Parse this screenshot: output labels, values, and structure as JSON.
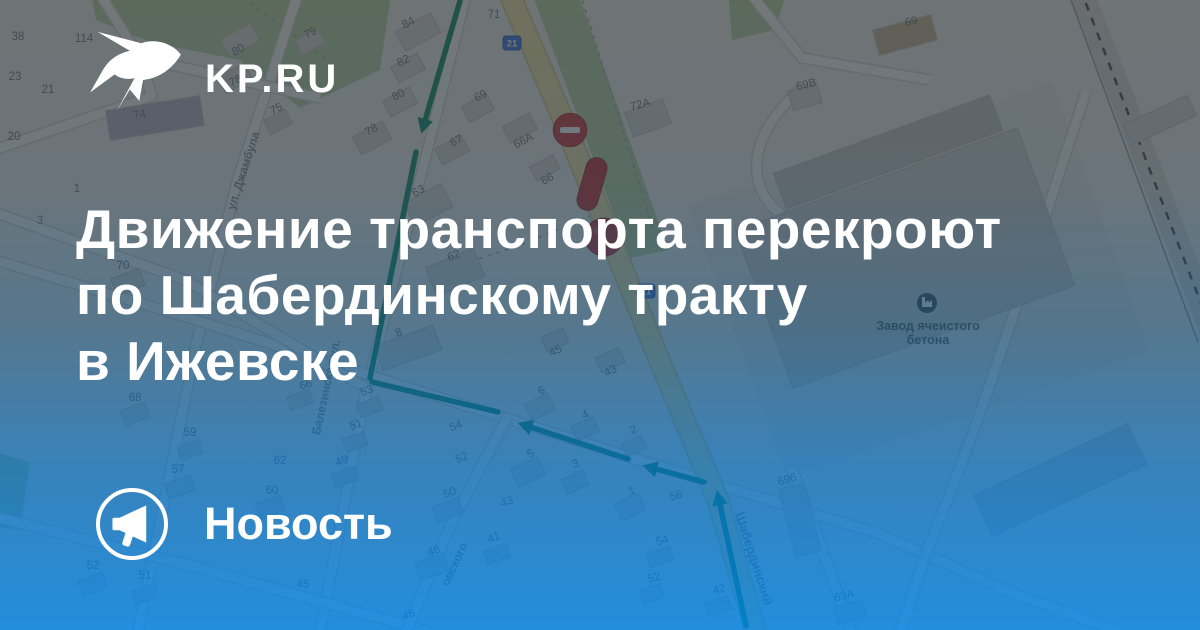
{
  "brand": {
    "logo_text": "KP.RU",
    "label": "Новость"
  },
  "headline": {
    "line1": "Движение транспорта перекроют",
    "line2": "по Шабердинскому тракту",
    "line3": "в Ижевске"
  },
  "colors": {
    "overlay_top": "#2c3439",
    "overlay_bottom": "#017edb",
    "text": "#ffffff",
    "route_green": "#0c8a63",
    "marker_red": "#d23438",
    "road_yellow": "#f2e4a2",
    "badge_blue": "#3d72d9"
  },
  "map": {
    "palette": {
      "land": "#f0efe9",
      "park": "#b9d2a0",
      "building": "#dbd8d1",
      "building_stroke": "#c3bfb6",
      "street_fill": "#fbfaf5",
      "street_casing": "#d6d3ca",
      "number_gray": "#737476",
      "label_gray": "#8b8d90",
      "poi_dark": "#3f4851"
    },
    "parks": [
      "M90,-12 L392,-12 L380,70 L300,108 L240,60 L150,42 L96,20 Z",
      "M728,-12 L788,-12 L775,30 L732,40 Z",
      "M530,-12 L576,-12 L668,250 L630,258 Z",
      "M-12,450 L30,462 L20,530 L-12,525 Z"
    ],
    "grounds": [
      "M688,206 L1052,82 L1150,352 L788,478 Z"
    ],
    "dashed_paths": [
      "M235,-8 L330,62",
      "M580,-8 L655,235",
      "M600,212 L520,245 L470,262"
    ],
    "streets": [
      "M468,-12 L428,148 L366,390 L320,632",
      "M300,-12 L238,178 L196,345 L138,632",
      "M-12,258 L180,315 L384,380 L700,479 L880,534 L1010,592 L1120,632",
      "M-12,210 L185,280 L366,388",
      "M-12,515 L200,568 L430,632",
      "M96,-12 L140,58 L152,96 L-12,152",
      "M140,58 L320,98",
      "M508,416 L452,522 L406,632",
      "M800,90 C742,140 742,200 802,228 L860,242",
      "M1086,92 C1030,260 990,400 928,548 L900,632",
      "M792,468 L852,632",
      "M746,-12 L802,58 L930,80"
    ],
    "tract": "M506,-14 L560,112 L600,212 L660,362 L718,500 L756,632",
    "railway": {
      "band": "M1080,-12 L1212,332",
      "dash": "M1080,-12 L1212,332",
      "thin": "M1068,-8 L1198,342"
    },
    "buildings": [
      {
        "x": 155,
        "y": 118,
        "w": 95,
        "h": 30,
        "r": -9,
        "f": "#b7b4c0"
      },
      {
        "x": 240,
        "y": 40,
        "w": 34,
        "h": 20,
        "r": -28
      },
      {
        "x": 235,
        "y": 78,
        "w": 30,
        "h": 18,
        "r": -28
      },
      {
        "x": 310,
        "y": 42,
        "w": 26,
        "h": 16,
        "r": -28
      },
      {
        "x": 278,
        "y": 122,
        "w": 24,
        "h": 16,
        "r": -28
      },
      {
        "x": 418,
        "y": 32,
        "w": 40,
        "h": 22,
        "r": -28
      },
      {
        "x": 408,
        "y": 68,
        "w": 30,
        "h": 18,
        "r": -28
      },
      {
        "x": 400,
        "y": 102,
        "w": 30,
        "h": 18,
        "r": -28
      },
      {
        "x": 372,
        "y": 138,
        "w": 34,
        "h": 20,
        "r": -28
      },
      {
        "x": 478,
        "y": 108,
        "w": 28,
        "h": 18,
        "r": -28
      },
      {
        "x": 452,
        "y": 150,
        "w": 30,
        "h": 18,
        "r": -28
      },
      {
        "x": 428,
        "y": 205,
        "w": 42,
        "h": 26,
        "r": -28
      },
      {
        "x": 520,
        "y": 128,
        "w": 30,
        "h": 18,
        "r": -28
      },
      {
        "x": 545,
        "y": 168,
        "w": 26,
        "h": 16,
        "r": -28
      },
      {
        "x": 648,
        "y": 118,
        "w": 40,
        "h": 26,
        "r": -20
      },
      {
        "x": 455,
        "y": 272,
        "w": 52,
        "h": 30,
        "r": -22
      },
      {
        "x": 408,
        "y": 348,
        "w": 62,
        "h": 26,
        "r": -20
      },
      {
        "x": 128,
        "y": 282,
        "w": 30,
        "h": 18,
        "r": -20
      },
      {
        "x": 555,
        "y": 340,
        "w": 24,
        "h": 16,
        "r": -25
      },
      {
        "x": 610,
        "y": 360,
        "w": 26,
        "h": 16,
        "r": -25
      },
      {
        "x": 540,
        "y": 407,
        "w": 26,
        "h": 18,
        "r": -25
      },
      {
        "x": 585,
        "y": 429,
        "w": 24,
        "h": 16,
        "r": -25
      },
      {
        "x": 634,
        "y": 446,
        "w": 22,
        "h": 14,
        "r": -25
      },
      {
        "x": 528,
        "y": 472,
        "w": 30,
        "h": 20,
        "r": -25
      },
      {
        "x": 575,
        "y": 482,
        "w": 24,
        "h": 16,
        "r": -25
      },
      {
        "x": 630,
        "y": 507,
        "w": 26,
        "h": 18,
        "r": -25
      },
      {
        "x": 93,
        "y": 584,
        "w": 26,
        "h": 16,
        "r": -20
      },
      {
        "x": 145,
        "y": 594,
        "w": 24,
        "h": 14,
        "r": -20
      },
      {
        "x": 180,
        "y": 487,
        "w": 28,
        "h": 16,
        "r": -20
      },
      {
        "x": 270,
        "y": 507,
        "w": 26,
        "h": 16,
        "r": -20
      },
      {
        "x": 345,
        "y": 477,
        "w": 24,
        "h": 14,
        "r": -20
      },
      {
        "x": 370,
        "y": 407,
        "w": 24,
        "h": 14,
        "r": -20
      },
      {
        "x": 355,
        "y": 442,
        "w": 22,
        "h": 14,
        "r": -20
      },
      {
        "x": 300,
        "y": 400,
        "w": 24,
        "h": 14,
        "r": -20
      },
      {
        "x": 135,
        "y": 414,
        "w": 26,
        "h": 16,
        "r": -20
      },
      {
        "x": 190,
        "y": 450,
        "w": 22,
        "h": 14,
        "r": -20
      },
      {
        "x": 448,
        "y": 510,
        "w": 28,
        "h": 16,
        "r": -20
      },
      {
        "x": 432,
        "y": 567,
        "w": 30,
        "h": 18,
        "r": -20
      },
      {
        "x": 497,
        "y": 554,
        "w": 24,
        "h": 14,
        "r": -20
      },
      {
        "x": 660,
        "y": 557,
        "w": 24,
        "h": 14,
        "r": -20
      },
      {
        "x": 652,
        "y": 594,
        "w": 22,
        "h": 14,
        "r": -20
      },
      {
        "x": 718,
        "y": 606,
        "w": 24,
        "h": 14,
        "r": -20
      },
      {
        "x": 800,
        "y": 520,
        "w": 26,
        "h": 70,
        "r": -15
      },
      {
        "x": 850,
        "y": 612,
        "w": 30,
        "h": 18,
        "r": -15
      },
      {
        "x": 805,
        "y": 97,
        "w": 30,
        "h": 20,
        "r": -15
      },
      {
        "x": 905,
        "y": 35,
        "w": 60,
        "h": 26,
        "r": -15,
        "f": "#c9b38f"
      },
      {
        "x": 905,
        "y": 258,
        "w": 300,
        "h": 168,
        "r": -20,
        "f": "#cfcfcb"
      },
      {
        "x": 888,
        "y": 152,
        "w": 230,
        "h": 38,
        "r": -20,
        "f": "#c6c6c2"
      },
      {
        "x": 1060,
        "y": 480,
        "w": 170,
        "h": 45,
        "r": -25,
        "f": "#cfcfcb"
      },
      {
        "x": 1160,
        "y": 120,
        "w": 70,
        "h": 22,
        "r": -25
      }
    ],
    "house_numbers": [
      {
        "t": "38",
        "x": 18,
        "y": 40
      },
      {
        "t": "114",
        "x": 84,
        "y": 42
      },
      {
        "t": "23",
        "x": 15,
        "y": 80
      },
      {
        "t": "21",
        "x": 48,
        "y": 93
      },
      {
        "t": "20",
        "x": 14,
        "y": 140
      },
      {
        "t": "1",
        "x": 77,
        "y": 192
      },
      {
        "t": "3",
        "x": 40,
        "y": 224
      },
      {
        "t": "74",
        "x": 140,
        "y": 118,
        "r": -8
      },
      {
        "t": "80",
        "x": 240,
        "y": 53,
        "r": -28
      },
      {
        "t": "78",
        "x": 237,
        "y": 84,
        "r": -28
      },
      {
        "t": "79",
        "x": 312,
        "y": 36,
        "r": -28
      },
      {
        "t": "75",
        "x": 278,
        "y": 112,
        "r": -28
      },
      {
        "t": "84",
        "x": 410,
        "y": 26,
        "r": -28
      },
      {
        "t": "82",
        "x": 405,
        "y": 64,
        "r": -28
      },
      {
        "t": "80",
        "x": 400,
        "y": 98,
        "r": -28
      },
      {
        "t": "78",
        "x": 373,
        "y": 133,
        "r": -28
      },
      {
        "t": "71",
        "x": 494,
        "y": 18
      },
      {
        "t": "69",
        "x": 482,
        "y": 99,
        "r": -28
      },
      {
        "t": "67",
        "x": 458,
        "y": 144,
        "r": -28
      },
      {
        "t": "63",
        "x": 420,
        "y": 194,
        "r": -28
      },
      {
        "t": "66А",
        "x": 525,
        "y": 144,
        "r": -28
      },
      {
        "t": "66",
        "x": 549,
        "y": 182,
        "r": -28
      },
      {
        "t": "72А",
        "x": 641,
        "y": 108,
        "r": -15
      },
      {
        "t": "70",
        "x": 123,
        "y": 269
      },
      {
        "t": "62",
        "x": 455,
        "y": 259,
        "r": -22
      },
      {
        "t": "8",
        "x": 400,
        "y": 336,
        "r": -20
      },
      {
        "t": "45",
        "x": 557,
        "y": 354,
        "r": -25
      },
      {
        "t": "43",
        "x": 612,
        "y": 374,
        "r": -25
      },
      {
        "t": "6",
        "x": 543,
        "y": 394,
        "r": -25
      },
      {
        "t": "4",
        "x": 587,
        "y": 418,
        "r": -25
      },
      {
        "t": "2",
        "x": 635,
        "y": 433,
        "r": -25
      },
      {
        "t": "5",
        "x": 532,
        "y": 457,
        "r": -25
      },
      {
        "t": "3",
        "x": 577,
        "y": 467,
        "r": -25
      },
      {
        "t": "1",
        "x": 633,
        "y": 494,
        "r": -25
      },
      {
        "t": "43",
        "x": 508,
        "y": 505,
        "r": -20
      },
      {
        "t": "56",
        "x": 677,
        "y": 499,
        "r": -15
      },
      {
        "t": "54",
        "x": 663,
        "y": 544,
        "r": -15
      },
      {
        "t": "52",
        "x": 655,
        "y": 581,
        "r": -15
      },
      {
        "t": "42",
        "x": 720,
        "y": 593,
        "r": -15
      },
      {
        "t": "69б",
        "x": 788,
        "y": 483,
        "r": -15
      },
      {
        "t": "69А",
        "x": 845,
        "y": 599,
        "r": -15
      },
      {
        "t": "68",
        "x": 135,
        "y": 401
      },
      {
        "t": "59",
        "x": 190,
        "y": 436
      },
      {
        "t": "53",
        "x": 368,
        "y": 394,
        "r": -20
      },
      {
        "t": "51",
        "x": 357,
        "y": 428,
        "r": -20
      },
      {
        "t": "66",
        "x": 307,
        "y": 388,
        "r": -20
      },
      {
        "t": "57",
        "x": 178,
        "y": 473
      },
      {
        "t": "62",
        "x": 280,
        "y": 464
      },
      {
        "t": "49",
        "x": 343,
        "y": 464,
        "r": -20
      },
      {
        "t": "60",
        "x": 272,
        "y": 494
      },
      {
        "t": "52",
        "x": 93,
        "y": 569
      },
      {
        "t": "51",
        "x": 145,
        "y": 579
      },
      {
        "t": "50",
        "x": 451,
        "y": 496,
        "r": -20
      },
      {
        "t": "48",
        "x": 435,
        "y": 554,
        "r": -20
      },
      {
        "t": "41",
        "x": 495,
        "y": 541,
        "r": -20
      },
      {
        "t": "46",
        "x": 410,
        "y": 618,
        "r": -20
      },
      {
        "t": "54",
        "x": 457,
        "y": 429,
        "r": -20
      },
      {
        "t": "52",
        "x": 463,
        "y": 461,
        "r": -20
      },
      {
        "t": "45",
        "x": 303,
        "y": 588
      },
      {
        "t": "69В",
        "x": 807,
        "y": 88,
        "r": -14
      },
      {
        "t": "69",
        "x": 912,
        "y": 25,
        "r": -14
      }
    ],
    "street_labels": [
      {
        "t": "ул. Джамбула",
        "x": 247,
        "y": 172,
        "r": -72,
        "s": 12
      },
      {
        "t": "Балезинская ул.",
        "x": 330,
        "y": 388,
        "r": -78,
        "s": 12
      },
      {
        "t": "Шабердинский",
        "x": 750,
        "y": 560,
        "r": 72,
        "s": 13
      },
      {
        "t": "овского",
        "x": 458,
        "y": 566,
        "r": -65,
        "s": 12
      }
    ],
    "poi": {
      "icon_x": 927,
      "icon_y": 303,
      "name_line1": "Завод ячеистого",
      "name_line2": "бетона",
      "label_x": 928,
      "label_y1": 330,
      "label_y2": 344
    },
    "route": [
      {
        "p": [
          [
            462,
            -6
          ],
          [
            424,
            124
          ]
        ],
        "a": true
      },
      {
        "p": [
          [
            416,
            152
          ],
          [
            370,
            378
          ]
        ],
        "a": false
      },
      {
        "p": [
          [
            372,
            382
          ],
          [
            498,
            412
          ]
        ],
        "a": false
      },
      {
        "p": [
          [
            704,
            482
          ],
          [
            652,
            468
          ]
        ],
        "a": true
      },
      {
        "p": [
          [
            628,
            459
          ],
          [
            527,
            426
          ]
        ],
        "a": true
      },
      {
        "p": [
          [
            746,
            626
          ],
          [
            719,
            500
          ]
        ],
        "a": true
      }
    ],
    "markers": {
      "no_entry": {
        "x": 570,
        "y": 130,
        "r": 16.5
      },
      "capsule": {
        "x": 592,
        "y": 184,
        "w": 21,
        "l": 54,
        "rot": 16
      },
      "ball": {
        "x": 604,
        "y": 237,
        "r": 19
      }
    },
    "badges": [
      {
        "t": "21",
        "x": 512,
        "y": 43
      },
      {
        "t": "21",
        "x": 646,
        "y": 291
      }
    ]
  }
}
